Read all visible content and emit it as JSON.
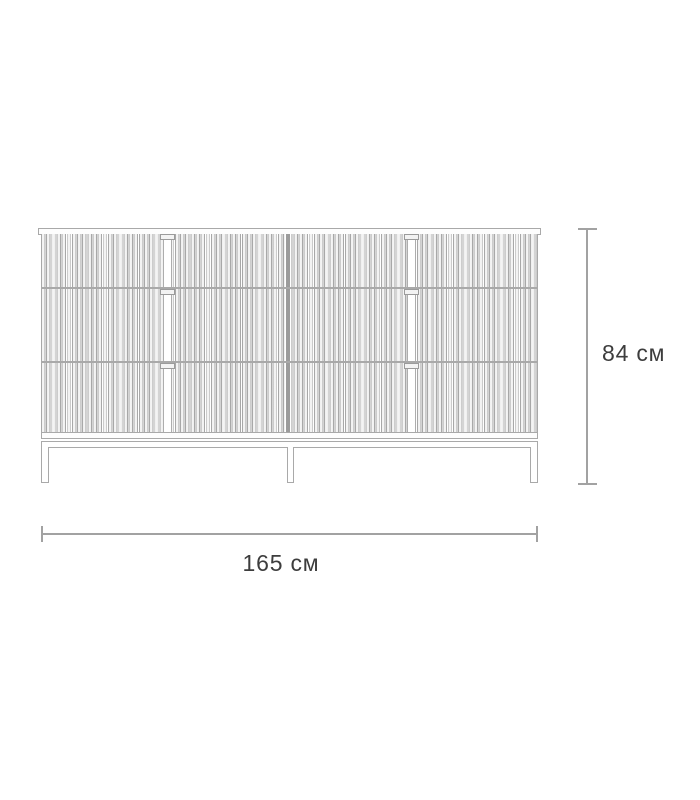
{
  "diagram": {
    "type": "furniture-dimension-drawing",
    "item": "fluted-front dresser / sideboard, front elevation",
    "dimensions": {
      "height_label": "84 см",
      "height_value": 84,
      "width_label": "165 см",
      "width_value": 165,
      "unit": "см"
    },
    "structure": {
      "drawer_rows": 3,
      "drawer_columns": 2,
      "handles": 6,
      "legs": 3,
      "front_style": "vertical slats"
    },
    "colors": {
      "background": "#ffffff",
      "line": "#a9a9a9",
      "slat_fill": "#eeeeee",
      "center_divider": "#9c9c9c",
      "dimension_line": "#a2a2a2",
      "label_text": "#3d3d3d"
    }
  }
}
